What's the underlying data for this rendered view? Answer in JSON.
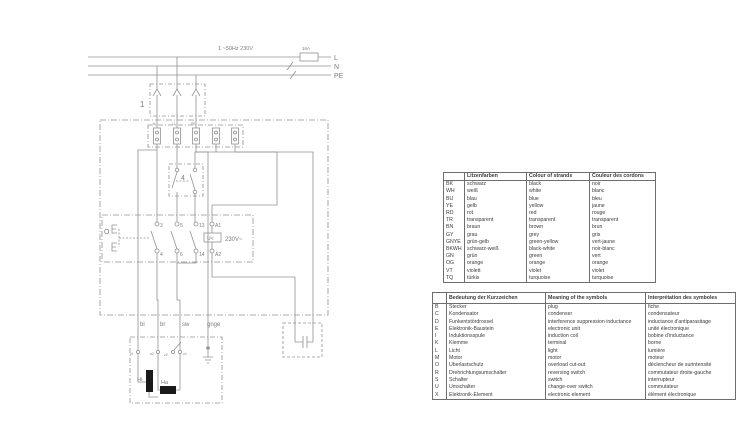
{
  "diagram": {
    "supply": {
      "rating": "1 ~50Hz 230V",
      "fuse": "16A",
      "lines": [
        "L",
        "N",
        "PE"
      ]
    },
    "plug_box_label": "1",
    "terminal_labels": [
      "N",
      "L1",
      "PE"
    ],
    "switch_box_label": "4",
    "contacts": {
      "actuator": "O",
      "top": [
        "3",
        "5",
        "13",
        "A1"
      ],
      "bottom": [
        "4",
        "6",
        "14",
        "A2"
      ],
      "coil": "U<",
      "coil_voltage": "230V~"
    },
    "wire_labels": [
      "bl",
      "br",
      "sw",
      "gnge"
    ],
    "motor": {
      "terminals": [
        "z1",
        "u2",
        "z2",
        "u1"
      ],
      "elements": [
        "Hi",
        "Ha"
      ]
    }
  },
  "color_table": {
    "headers": [
      "",
      "Litzenfarben",
      "Colour of strands",
      "Couleur des cordons"
    ],
    "rows": [
      [
        "BK",
        "schwarz",
        "black",
        "noir"
      ],
      [
        "WH",
        "weiß",
        "white",
        "blanc"
      ],
      [
        "BU",
        "blau",
        "blue",
        "bleu"
      ],
      [
        "YE",
        "gelb",
        "yellow",
        "jaune"
      ],
      [
        "RD",
        "rot",
        "red",
        "rouge"
      ],
      [
        "TR",
        "transparent",
        "transparent",
        "transparent"
      ],
      [
        "BN",
        "braun",
        "brown",
        "brun"
      ],
      [
        "GY",
        "grau",
        "grey",
        "gris"
      ],
      [
        "GNYE",
        "grün-gelb",
        "green-yellow",
        "vert-jaune"
      ],
      [
        "BKWH",
        "schwarz-weiß",
        "black-white",
        "noir-blanc"
      ],
      [
        "GN",
        "grün",
        "green",
        "vert"
      ],
      [
        "OG",
        "orange",
        "orange",
        "orange"
      ],
      [
        "VT",
        "violett",
        "violet",
        "violet"
      ],
      [
        "TQ",
        "türkis",
        "turquoise",
        "turquoise"
      ]
    ]
  },
  "symbol_table": {
    "headers": [
      "",
      "Bedeutung der Kurzzeichen",
      "Meaning of the symbols",
      "Interprétation des symboles"
    ],
    "rows": [
      [
        "B",
        "Stecker",
        "plug",
        "fiche"
      ],
      [
        "C",
        "Kondensator",
        "condenser",
        "condensateur"
      ],
      [
        "D",
        "Funkentstördrossel",
        "interference suppression inductance",
        "inductance d'antiparasitage"
      ],
      [
        "E",
        "Elektronik-Baustein",
        "electronic unit",
        "unité électronique"
      ],
      [
        "I",
        "Induktionsspule",
        "induction coil",
        "bobine d'inductance"
      ],
      [
        "K",
        "Klemme",
        "terminal",
        "borne"
      ],
      [
        "L",
        "Licht",
        "light",
        "lumière"
      ],
      [
        "M",
        "Motor",
        "motor",
        "moteur"
      ],
      [
        "O",
        "Überlastschutz",
        "overload cut-out",
        "déclencheur de surintensité"
      ],
      [
        "R",
        "Drehrichtungsumschalter",
        "reversing switch",
        "commutateur droite-gauche"
      ],
      [
        "S",
        "Schalter",
        "switch",
        "interrupteur"
      ],
      [
        "U",
        "Umschalter",
        "change-over switch",
        "commutateur"
      ],
      [
        "X",
        "Elektronik-Element",
        "electronic element",
        "élément électronique"
      ]
    ]
  }
}
